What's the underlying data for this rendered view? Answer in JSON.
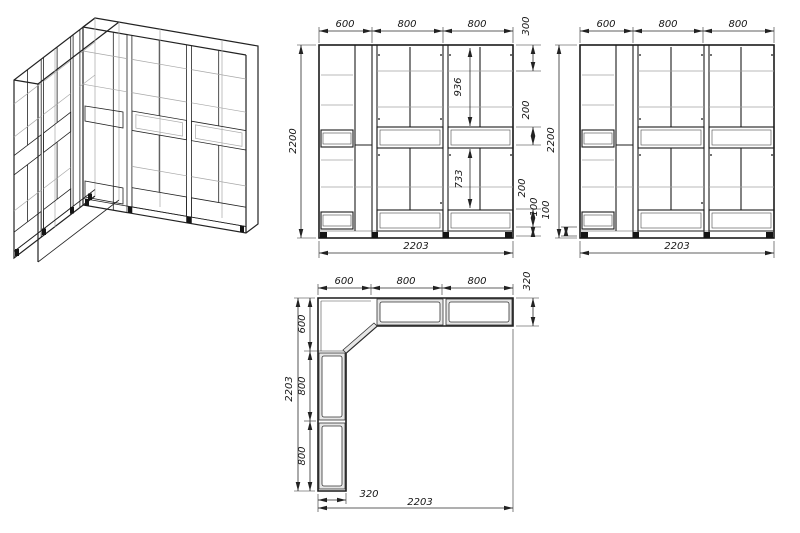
{
  "drawing_title": "corner-wardrobe-technical-drawing",
  "front": {
    "top": [
      "600",
      "800",
      "800"
    ],
    "height": "2200",
    "right": [
      "300",
      "200",
      "200",
      "100"
    ],
    "inner": [
      "936",
      "733"
    ],
    "width": "2203"
  },
  "side": {
    "top": [
      "600",
      "800",
      "800"
    ],
    "height": "2200",
    "plinth": "100",
    "width": "2203"
  },
  "plan": {
    "top": [
      "600",
      "800",
      "800"
    ],
    "depth_right": "320",
    "left": [
      "600",
      "800",
      "800"
    ],
    "length_left": "2203",
    "depth_bottom": "320",
    "width_bottom": "2203"
  },
  "colors": {
    "line": "#1c1c1c",
    "light_line": "#a3a3a3",
    "dimension": "#2a2a2a",
    "wall_fill": "#e6e6e6",
    "background": "#ffffff"
  }
}
